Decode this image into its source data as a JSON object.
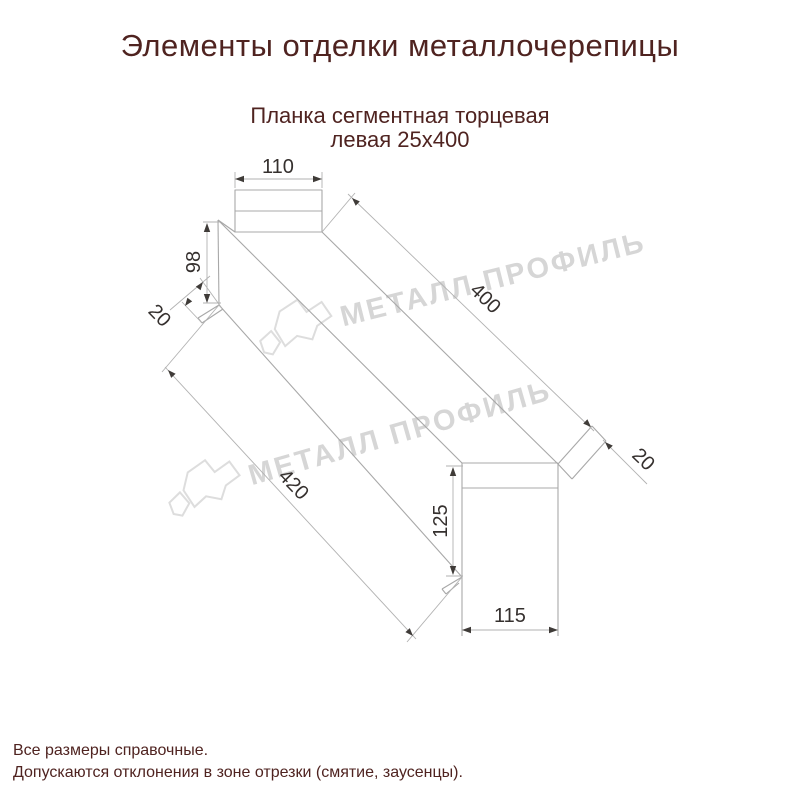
{
  "title": "Элементы отделки металлочерепицы",
  "product": {
    "line1": "Планка сегментная торцевая",
    "line2": "левая 25х400"
  },
  "dimensions": {
    "flange_width": "110",
    "left_height": "98",
    "left_hem": "20",
    "top_length": "400",
    "bottom_length": "420",
    "end_height": "125",
    "end_width": "115",
    "end_hem": "20"
  },
  "watermark_text": "МЕТАЛЛ ПРОФИЛЬ",
  "footer": {
    "line1": "Все размеры справочные.",
    "line2": "Допускаются отклонения в зоне отрезки (смятие, заусенцы)."
  },
  "colors": {
    "heading": "#4f2320",
    "dimension_text": "#35302e",
    "drawing_line": "#a8a8a8",
    "dimension_line": "#b2b2b2",
    "arrow": "#3f3b38",
    "watermark": "#d6d6d6",
    "logo_stroke": "#dddddd",
    "background": "#ffffff"
  }
}
